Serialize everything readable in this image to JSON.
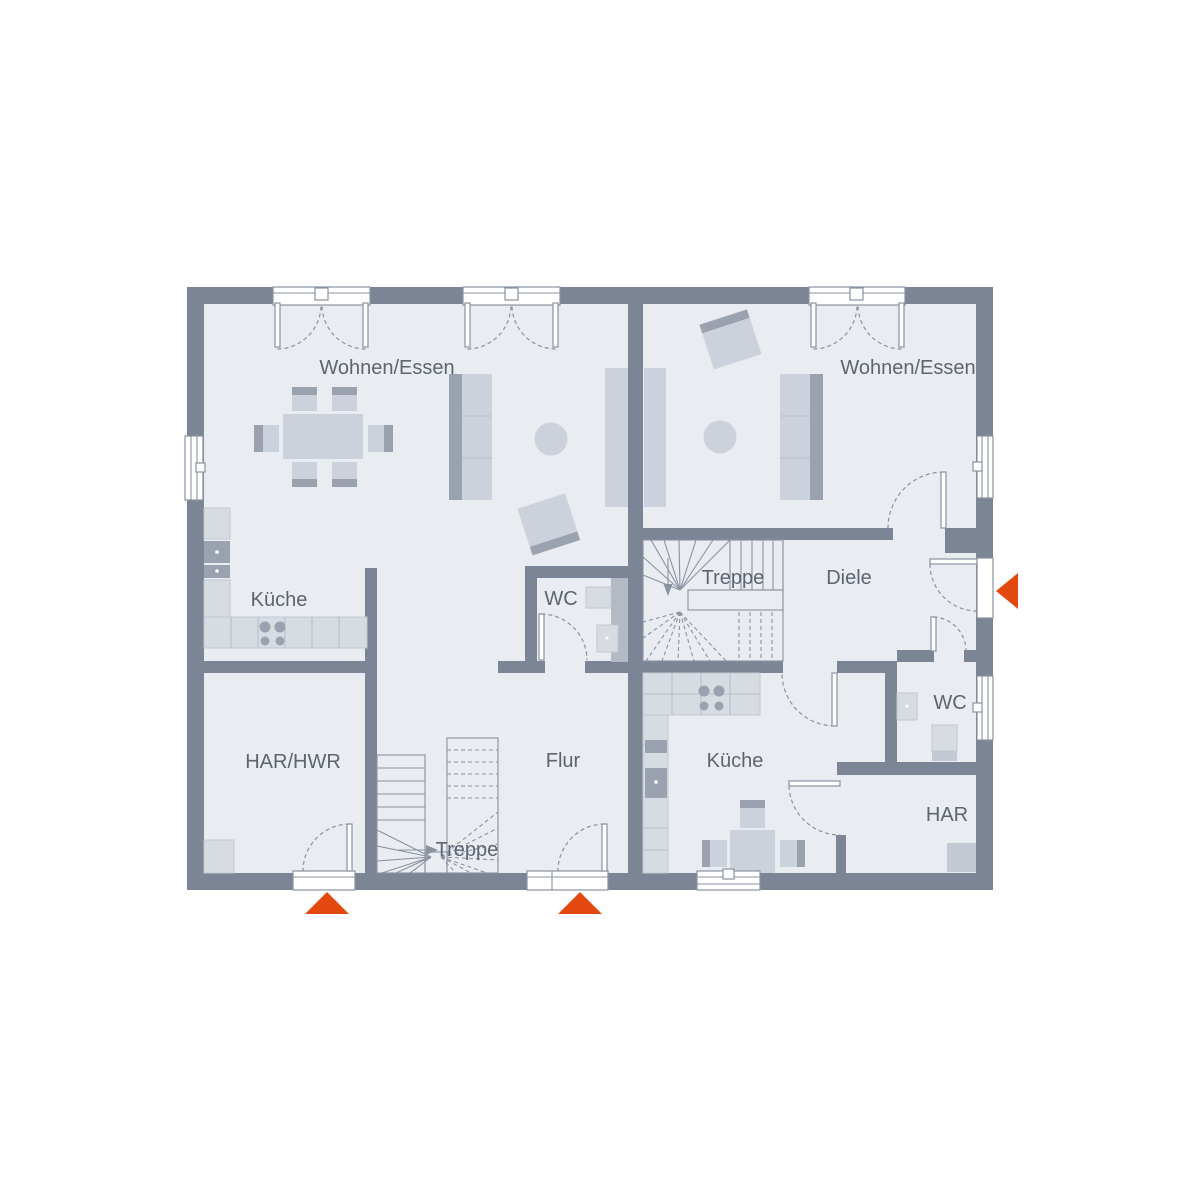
{
  "plan": {
    "type": "floor-plan",
    "labels": {
      "left": {
        "living": "Wohnen/Essen",
        "kitchen": "Küche",
        "wc": "WC",
        "utility": "HAR/HWR",
        "hall": "Flur",
        "stairs": "Treppe"
      },
      "right": {
        "living": "Wohnen/Essen",
        "kitchen": "Küche",
        "wc": "WC",
        "storage": "HAR",
        "entry": "Diele",
        "stairs": "Treppe"
      }
    },
    "colors": {
      "wall": "#7b8595",
      "floor": "#e9ecf1",
      "furniture_light": "#ccd2db",
      "furniture_mid": "#c3c9d3",
      "furniture_dark": "#9aa2af",
      "counter": "#d7dbe2",
      "accent": "#e3490f",
      "label_text": "#5d6570",
      "line": "#8a93a0",
      "background": "#ffffff"
    }
  }
}
